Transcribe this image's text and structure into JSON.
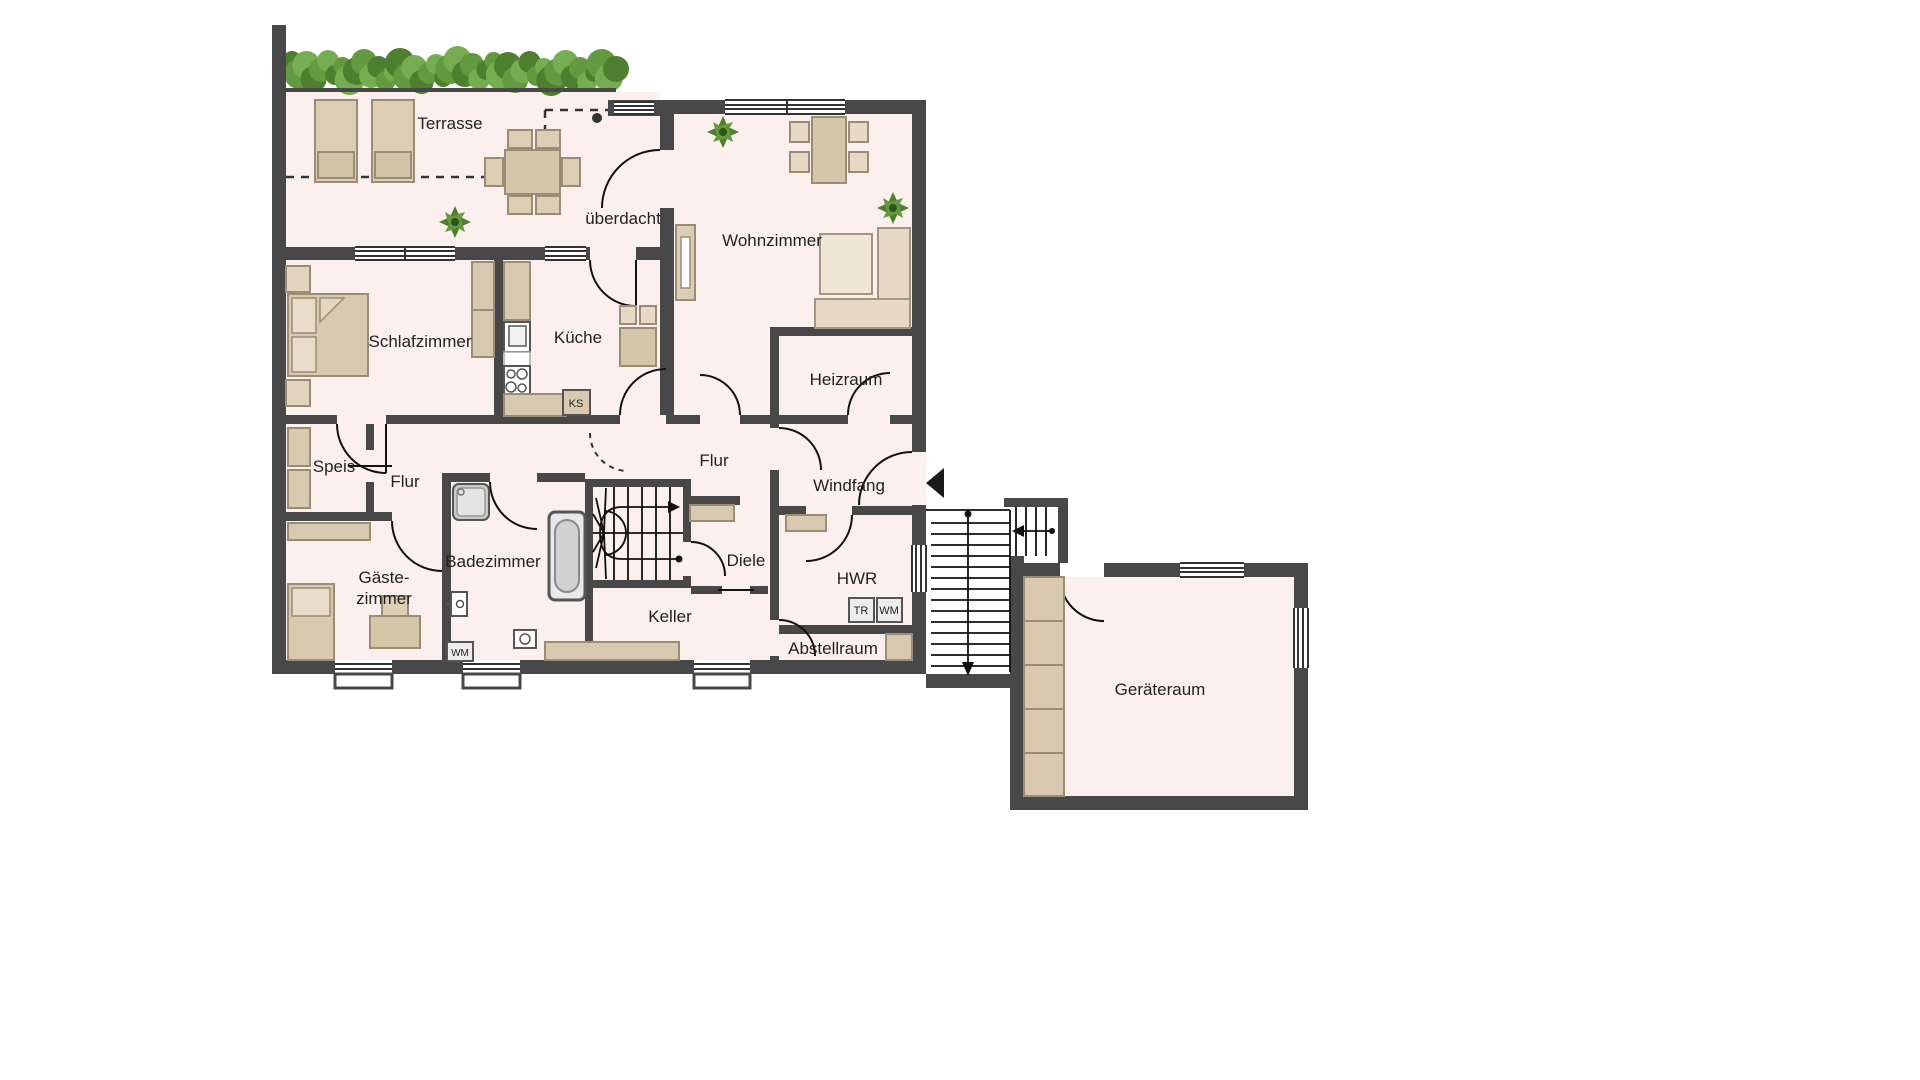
{
  "floorplan": {
    "rooms": {
      "terrasse": "Terrasse",
      "ueberdacht": "überdacht",
      "wohnzimmer": "Wohnzimmer",
      "schlafzimmer": "Schlafzimmer",
      "kueche": "Küche",
      "heizraum": "Heizraum",
      "speis": "Speis",
      "flur_links": "Flur",
      "flur_mitte": "Flur",
      "windfang": "Windfang",
      "badezimmer": "Badezimmer",
      "gaestezimmer_line1": "Gäste-",
      "gaestezimmer_line2": "zimmer",
      "diele": "Diele",
      "hwr": "HWR",
      "keller": "Keller",
      "abstellraum": "Abstellraum",
      "geraeteraum": "Geräteraum"
    },
    "appliances": {
      "ks": "KS",
      "tr": "TR",
      "wm": "WM",
      "wm_bad": "WM"
    },
    "colors": {
      "wall": "#484848",
      "floor": "#FBF0EE",
      "furniture": "#D9CBB4",
      "hedge_green": "#55883A"
    }
  }
}
